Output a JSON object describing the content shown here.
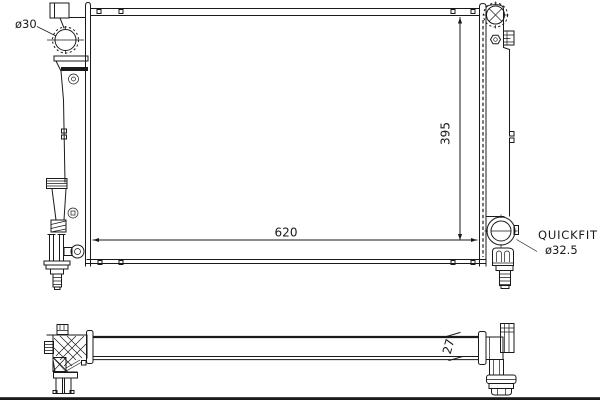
{
  "drawing": {
    "type": "technical-part-diagram",
    "subject": "radiator front and bottom view",
    "background": "#ffffff",
    "line_color": "#1a1a1a",
    "labels": {
      "inlet_diameter": "ø30",
      "core_width": "620",
      "core_height": "395",
      "outlet_fitting": "QUICKFIT",
      "outlet_diameter": "ø32.5",
      "core_depth": "27"
    }
  }
}
